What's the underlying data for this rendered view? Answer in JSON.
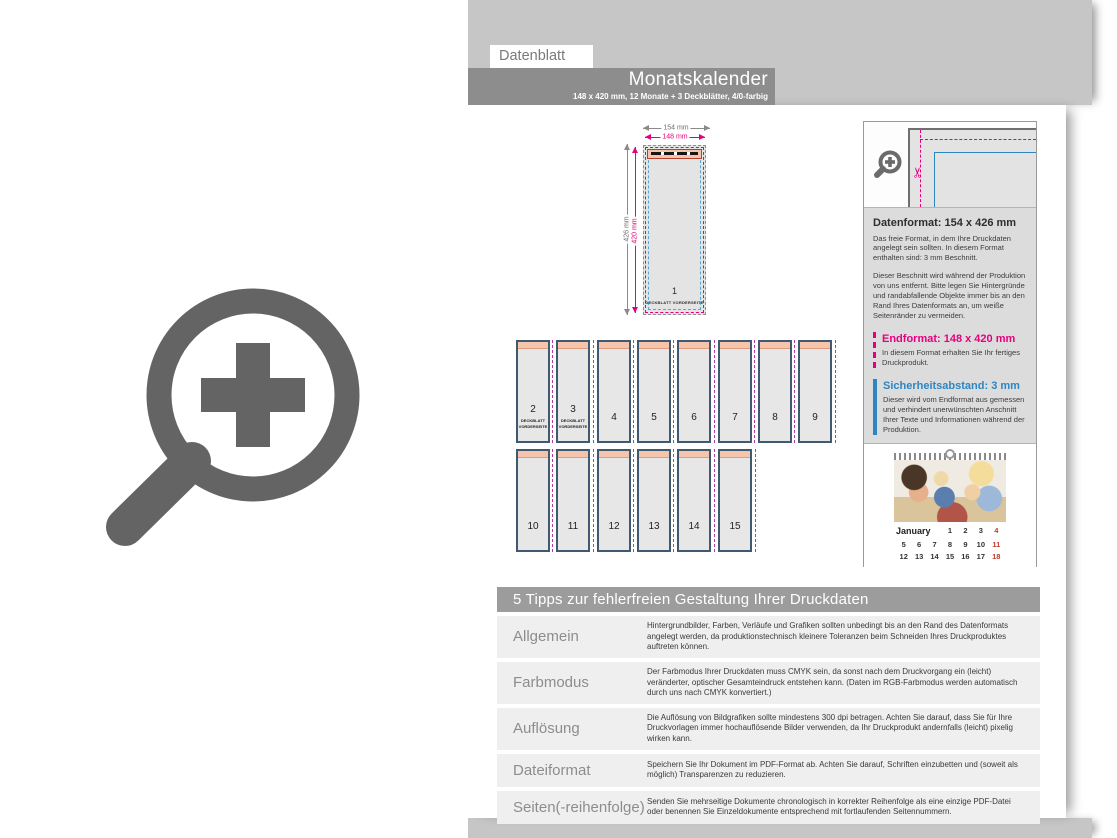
{
  "header": {
    "tab": "Datenblatt",
    "title": "Monatskalender",
    "subtitle": "148 x 420 mm, 12 Monate + 3 Deckblätter, 4/0-farbig"
  },
  "diagram": {
    "dim_width_outer": "154 mm",
    "dim_width_inner": "148 mm",
    "dim_height_outer": "426 mm",
    "dim_height_inner": "420 mm",
    "main_page": {
      "number": "1",
      "label": "DECKBLATT VORDERSEITE"
    },
    "row1": [
      {
        "number": "2",
        "label": "DECKBLATT VORDERSEITE"
      },
      {
        "number": "3",
        "label": "DECKBLATT VORDERSEITE"
      },
      {
        "number": "4"
      },
      {
        "number": "5"
      },
      {
        "number": "6"
      },
      {
        "number": "7"
      },
      {
        "number": "8"
      },
      {
        "number": "9"
      }
    ],
    "row2": [
      {
        "number": "10"
      },
      {
        "number": "11"
      },
      {
        "number": "12"
      },
      {
        "number": "13"
      },
      {
        "number": "14"
      },
      {
        "number": "15"
      }
    ]
  },
  "sidebar": {
    "datenformat": {
      "title": "Datenformat: 154 x 426 mm",
      "text1": "Das freie Format, in dem Ihre Druckdaten angelegt sein sollten. In diesem Format enthalten sind: 3 mm Beschnitt.",
      "text2": "Dieser Beschnitt wird während der Produktion von uns entfernt. Bitte legen Sie Hintergründe und randabfallende Objekte immer bis an den Rand Ihres Datenformats an, um weiße Seitenränder zu vermeiden."
    },
    "endformat": {
      "title": "Endformat: 148 x 420 mm",
      "text": "In diesem Format erhalten Sie Ihr fertiges Druckprodukt."
    },
    "sicherheitsabstand": {
      "title": "Sicherheitsabstand: 3 mm",
      "text": "Dieser wird vom Endformat aus gemessen und verhindert unerwünschten Anschnitt Ihrer Texte und Informationen während der Produktion."
    },
    "calendar": {
      "month": "January",
      "weeks": [
        [
          "1",
          "2",
          "3",
          "4"
        ],
        [
          "5",
          "6",
          "7",
          "8",
          "9",
          "10",
          "11"
        ],
        [
          "12",
          "13",
          "14",
          "15",
          "16",
          "17",
          "18"
        ]
      ]
    }
  },
  "tips": {
    "title": "5 Tipps zur fehlerfreien Gestaltung Ihrer Druckdaten",
    "rows": [
      {
        "label": "Allgemein",
        "text": "Hintergrundbilder, Farben, Verläufe und Grafiken sollten unbedingt bis an den Rand des Datenformats angelegt werden, da produktionstechnisch kleinere Toleranzen beim Schneiden Ihres Druckproduktes auftreten können."
      },
      {
        "label": "Farbmodus",
        "text": "Der Farbmodus Ihrer Druckdaten muss CMYK sein, da sonst nach dem Druckvorgang ein (leicht) veränderter, optischer Gesamteindruck entstehen kann. (Daten im RGB-Farbmodus werden automatisch durch uns nach CMYK konvertiert.)"
      },
      {
        "label": "Auflösung",
        "text": "Die Auflösung von Bildgrafiken sollte mindestens 300 dpi betragen. Achten Sie darauf, dass Sie für Ihre Druckvorlagen immer hochauflösende Bilder verwenden, da Ihr Druckprodukt andernfalls (leicht) pixelig wirken kann."
      },
      {
        "label": "Dateiformat",
        "text": "Speichern Sie Ihr Dokument im PDF-Format ab. Achten Sie darauf, Schriften einzubetten und (soweit als möglich) Transparenzen zu reduzieren."
      },
      {
        "label": "Seiten(-reihenfolge)",
        "text": "Senden Sie mehrseitige Dokumente chronologisch in korrekter Reihenfolge als eine einzige PDF-Datei oder benennen Sie Einzeldokumente entsprechend mit fortlaufenden Seitennummern."
      }
    ]
  },
  "icons": {
    "scissors_glyph": "✂",
    "watermark": "magnifier-plus-icon",
    "detail_zoom": "magnifier-plus-icon"
  },
  "colors": {
    "magenta": "#e6007e",
    "blue": "#2e86c1",
    "salmon": "#f6c3ab",
    "tileborder": "#3f5a70",
    "headergray": "#8d8d8d",
    "backdrop": "#c6c6c6",
    "calred": "#c0392b",
    "pagefill": "#e4e4e4"
  }
}
